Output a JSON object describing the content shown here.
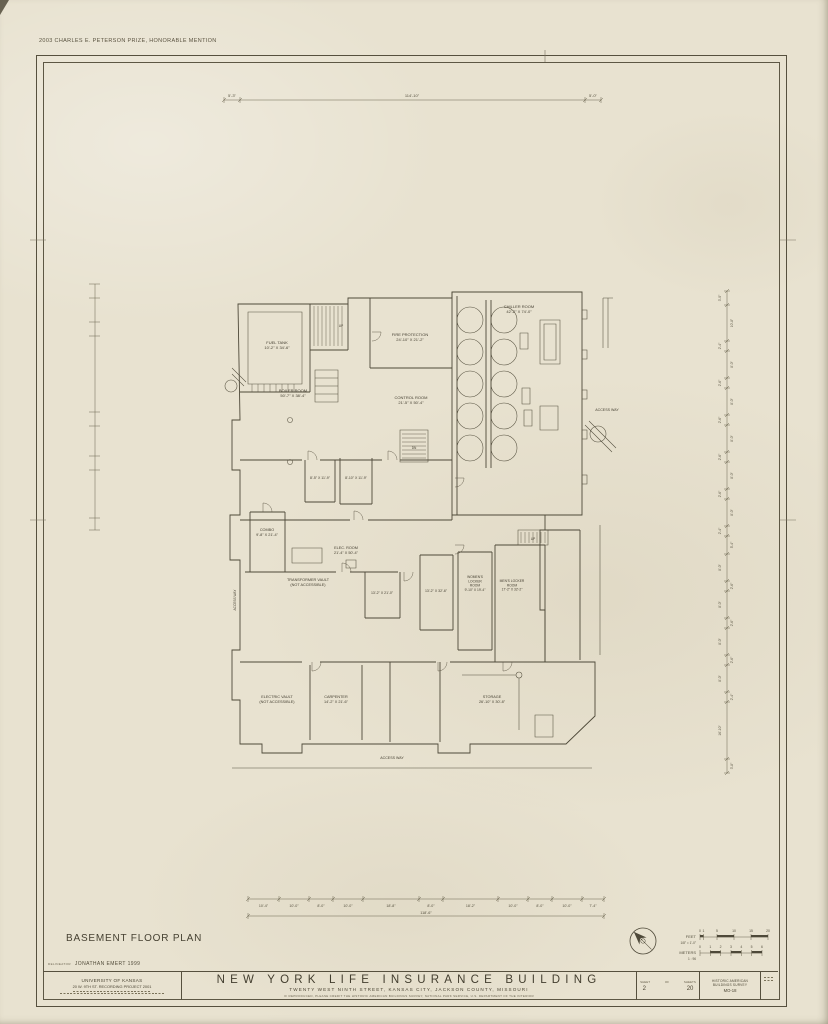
{
  "award": "2003 CHARLES E. PETERSON PRIZE, HONORABLE MENTION",
  "drawing_title": "BASEMENT FLOOR PLAN",
  "plan": {
    "labels": [
      {
        "x": 277,
        "y": 344,
        "fs": 4,
        "lines": [
          "FUEL TANK",
          "10'-2\" X 34'-6\""
        ]
      },
      {
        "x": 410,
        "y": 336,
        "fs": 4,
        "lines": [
          "FIRE PROTECTION",
          "24'-10\" X 21'-2\""
        ]
      },
      {
        "x": 293,
        "y": 392,
        "fs": 4,
        "lines": [
          "BOILER ROOM",
          "50'-7\" X 38'-4\""
        ]
      },
      {
        "x": 411,
        "y": 399,
        "fs": 4,
        "lines": [
          "CONTROL ROOM",
          "21'-5\" X 50'-4\""
        ]
      },
      {
        "x": 519,
        "y": 308,
        "fs": 4,
        "lines": [
          "CHILLER ROOM",
          "42'-2\" X 74'-0\""
        ]
      },
      {
        "x": 607,
        "y": 411,
        "fs": 3.6,
        "lines": [
          "ACCESS WAY"
        ]
      },
      {
        "x": 267,
        "y": 531,
        "fs": 3.8,
        "lines": [
          "COMBO",
          "9'-8\" X 21'-4\""
        ]
      },
      {
        "x": 346,
        "y": 549,
        "fs": 3.8,
        "lines": [
          "ELEC. ROOM",
          "21'-4\" X 50'-4\""
        ]
      },
      {
        "x": 320,
        "y": 479,
        "fs": 3.5,
        "lines": [
          "8'-5\" X 11'-9\""
        ]
      },
      {
        "x": 356,
        "y": 479,
        "fs": 3.5,
        "lines": [
          "8'-10\" X 11'-9\""
        ]
      },
      {
        "x": 308,
        "y": 581,
        "fs": 3.8,
        "lines": [
          "TRANSFORMER VAULT",
          "(NOT ACCESSIBLE)"
        ]
      },
      {
        "x": 382,
        "y": 594,
        "fs": 3.5,
        "lines": [
          "13'-2\" X 21'-0\""
        ]
      },
      {
        "x": 436,
        "y": 592,
        "fs": 3.5,
        "lines": [
          "13'-2\" X 32'-6\""
        ]
      },
      {
        "x": 475,
        "y": 578,
        "fs": 3.3,
        "lines": [
          "WOMEN'S",
          "LOCKER",
          "ROOM",
          "9'-10\" X 19'-4\""
        ]
      },
      {
        "x": 512,
        "y": 582,
        "fs": 3.3,
        "lines": [
          "MEN'S LOCKER",
          "ROOM",
          "17'-2\" X 32'-2\""
        ]
      },
      {
        "x": 277,
        "y": 698,
        "fs": 3.8,
        "lines": [
          "ELECTRIC VAULT",
          "(NOT ACCESSIBLE)"
        ]
      },
      {
        "x": 336,
        "y": 698,
        "fs": 3.8,
        "lines": [
          "CARPENTER",
          "14'-2\" X 21'-6\""
        ]
      },
      {
        "x": 492,
        "y": 698,
        "fs": 3.8,
        "lines": [
          "STORAGE",
          "26'-10\" X 30'-8\""
        ]
      },
      {
        "x": 392,
        "y": 759,
        "fs": 3.6,
        "lines": [
          "ACCESS WAY"
        ]
      },
      {
        "x": 236,
        "y": 600,
        "fs": 3.2,
        "rot": -90,
        "lines": [
          "ACCESS WAY"
        ]
      },
      {
        "x": 341,
        "y": 327,
        "fs": 3.2,
        "lines": [
          "UP"
        ]
      },
      {
        "x": 414,
        "y": 449,
        "fs": 3.2,
        "lines": [
          "DN"
        ]
      },
      {
        "x": 533,
        "y": 540,
        "fs": 3.2,
        "lines": [
          "UP"
        ]
      }
    ]
  },
  "dimensions": {
    "top": {
      "y": 100,
      "ticks": [
        224,
        240,
        585,
        601
      ],
      "labels": [
        {
          "t": "5'-3\"",
          "x": 232
        },
        {
          "t": "114'-10\"",
          "x": 412
        },
        {
          "t": "5'-0\"",
          "x": 593
        }
      ]
    },
    "bottom": {
      "y": 899,
      "ticks": [
        248,
        279,
        309,
        333,
        363,
        419,
        443,
        498,
        528,
        552,
        582,
        604
      ],
      "labels": [
        "10'-4\"",
        "10'-0\"",
        "8'-0\"",
        "10'-0\"",
        "18'-8\"",
        "8'-0\"",
        "18'-2\"",
        "10'-0\"",
        "8'-0\"",
        "10'-0\"",
        "7'-4\""
      ],
      "total": {
        "t": "118'-6\"",
        "y": 916,
        "x0": 248,
        "x1": 604
      }
    },
    "right": {
      "x": 727,
      "y0": 291,
      "segs": [
        [
          "3'-0\"",
          14
        ],
        [
          "10'-8\"",
          36
        ],
        [
          "2'-4\"",
          10
        ],
        [
          "8'-0\"",
          27
        ],
        [
          "2'-6\"",
          10
        ],
        [
          "8'-0\"",
          27
        ],
        [
          "2'-6\"",
          10
        ],
        [
          "8'-0\"",
          27
        ],
        [
          "2'-6\"",
          10
        ],
        [
          "8'-0\"",
          27
        ],
        [
          "2'-6\"",
          10
        ],
        [
          "8'-0\"",
          27
        ],
        [
          "2'-4\"",
          10
        ],
        [
          "5'-4\"",
          18
        ],
        [
          "8'-0\"",
          27
        ],
        [
          "2'-6\"",
          10
        ],
        [
          "8'-0\"",
          27
        ],
        [
          "2'-6\"",
          10
        ],
        [
          "8'-0\"",
          27
        ],
        [
          "2'-6\"",
          10
        ],
        [
          "8'-0\"",
          27
        ],
        [
          "2'-4\"",
          10
        ],
        [
          "16'-10\"",
          57
        ],
        [
          "3'-8\"",
          14
        ]
      ]
    }
  },
  "scale": {
    "feet_label": "FEET",
    "feet_ticks": [
      "0",
      "1",
      "5",
      "10",
      "15",
      "20"
    ],
    "feet_note": "1/8\" = 1'-0\"",
    "meters_label": "METERS",
    "meters_ticks": [
      "0",
      "1",
      "2",
      "3",
      "4",
      "5",
      "6"
    ],
    "meters_note": "1 : 96"
  },
  "title_block": {
    "delineator_label": "DELINEATOR",
    "delineator": "JONATHAN EMERT 1999",
    "agency_line1": "UNIVERSITY OF KANSAS",
    "agency_line2": "20 W. 9TH ST. RECORDING PROJECT 2001",
    "building_name": "NEW YORK LIFE INSURANCE BUILDING",
    "address": "TWENTY WEST NINTH STREET, KANSAS CITY, JACKSON COUNTY, MISSOURI",
    "credit_line": "IF REPRODUCED, PLEASE CREDIT THE HISTORIC AMERICAN BUILDINGS SURVEY, NATIONAL PARK SERVICE, U.S. DEPARTMENT OF THE INTERIOR",
    "sheet_label": "SHEET",
    "of_label": "OF",
    "sheets_label": "SHEETS",
    "sheet_number": "2",
    "sheet_total": "20",
    "survey_line1": "HISTORIC AMERICAN",
    "survey_line2": "BUILDINGS SURVEY",
    "survey_number": "MO-18"
  },
  "colors": {
    "paper": "#e8e2d0",
    "ink": "#4e4939"
  }
}
